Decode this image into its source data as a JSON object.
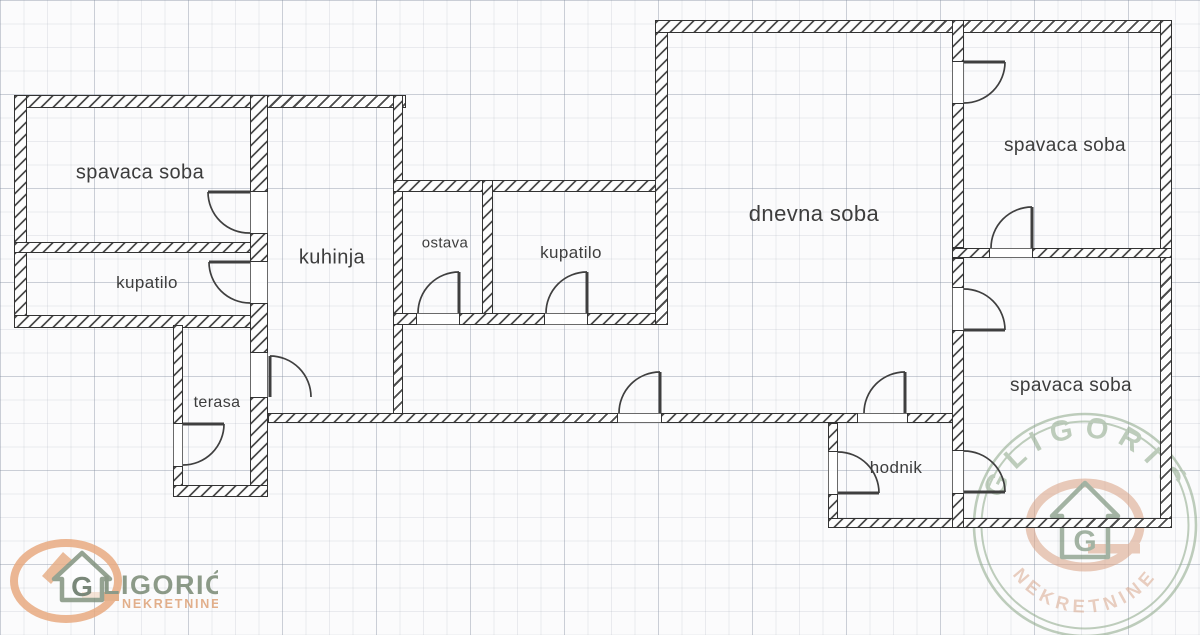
{
  "document": {
    "type": "apartment floor plan"
  },
  "rooms": {
    "bedroom1": {
      "label": "spavaca soba"
    },
    "bathroom1": {
      "label": "kupatilo"
    },
    "kitchen": {
      "label": "kuhinja"
    },
    "pantry": {
      "label": "ostava"
    },
    "bathroom2": {
      "label": "kupatilo"
    },
    "living_room": {
      "label": "dnevna soba"
    },
    "bedroom2": {
      "label": "spavaca soba"
    },
    "bedroom3": {
      "label": "spavaca soba"
    },
    "terrace": {
      "label": "terasa"
    },
    "hallway": {
      "label": "hodnik"
    }
  },
  "branding": {
    "agency_name": "GLIGORIĆ",
    "agency_monogram": "G",
    "agency_name_rest": "LIGORIĆ",
    "agency_subtitle": "NEKRETNINE",
    "colors": {
      "logo_green": "#74856f",
      "logo_orange": "#e0a173",
      "stamp_green": "#8ba687",
      "stamp_orange": "#d9a98f",
      "wall_dark": "#333333"
    }
  }
}
